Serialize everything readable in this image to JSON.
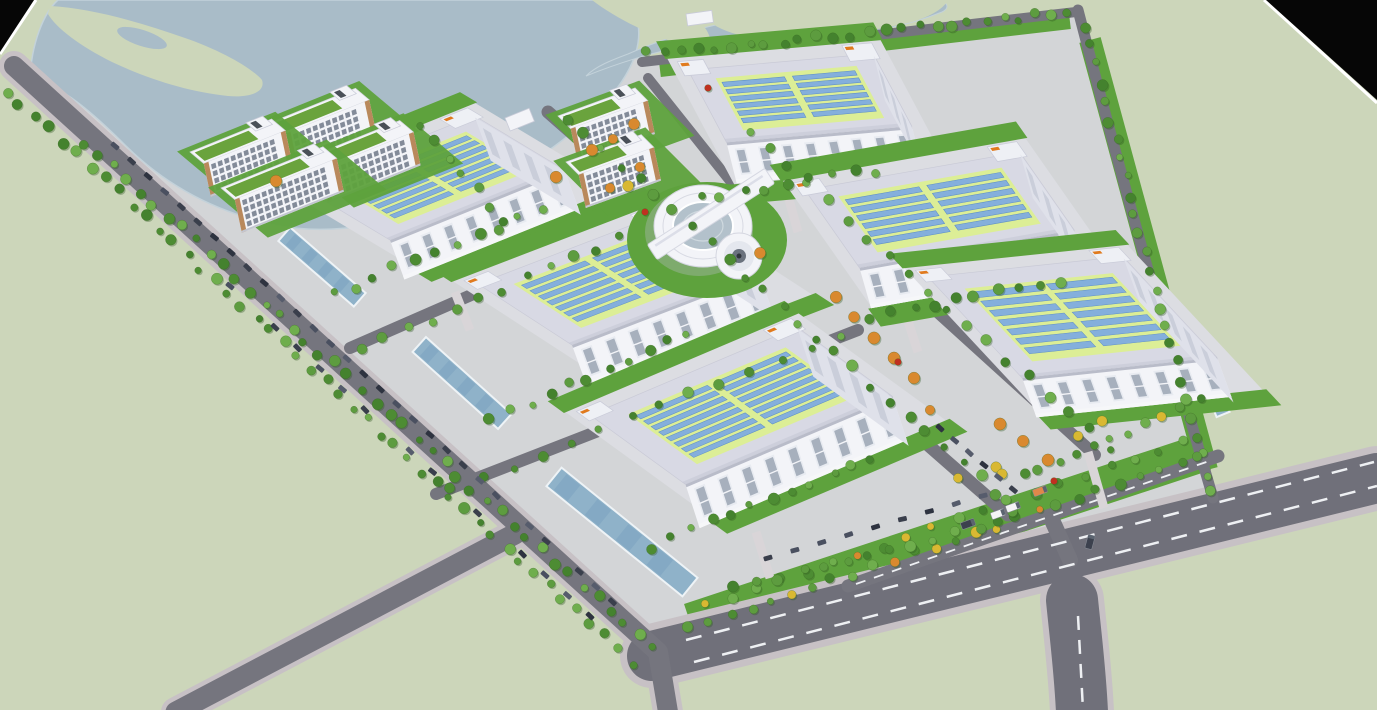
{
  "meta": {
    "description": "Aerial 3D architectural rendering of an industrial campus: six solar-roof warehouses, office slabs, ring-shaped hub building, tree-lined roads, lake at top, black render corners",
    "canvas": {
      "w": 1377,
      "h": 710
    }
  },
  "palette": {
    "land": "#ccd6ba",
    "site": "#d4d5d9",
    "water": "#a9bcc8",
    "waterEdge": "#c3d2da",
    "asphalt": "#75757e",
    "asphaltWide": "#70707a",
    "curb": "#c7c1c5",
    "dash": "#eef0f3",
    "lawn": "#5ea23d",
    "apron": "#dcdde2",
    "roofBorder": "#d8d9e4",
    "roofShadow": "#c6c8d6",
    "roofField": "#dcee96",
    "panel": "#84afdc",
    "panelEdge": "#5d8ec6",
    "white": "#f3f4f8",
    "eave": "#b9bcc9",
    "windowFrame": "#e8ebf1",
    "windowDark": "#a7b0bd",
    "sideWall": "#dfe1ea",
    "penthouse": "#eef0f5",
    "penthouseEdge": "#c9cbd8",
    "orangeMark": "#e07a1e",
    "officeTrim": "#b9895c",
    "officeRoof": "#6aa33d",
    "officeWin": "#6e7888",
    "glass": "#b3c1cb",
    "channel": "#8fb2c9",
    "channelDark": "#7ba3bf",
    "channelEdge": "#eef3f6",
    "walkway": "#d9d5d8",
    "treeGreens": [
      "#4d8c33",
      "#5d9c3f",
      "#6fae4d",
      "#44822e"
    ],
    "treeOrange": "#d9892f",
    "treeYellow": "#d9b832",
    "treeRed": "#c03020",
    "carColors": [
      "#3a3f4c",
      "#2e3340",
      "#4a5060",
      "#565c6c"
    ],
    "black": "#060606",
    "edgeLine": "#ffffff"
  },
  "scene": {
    "site_polygon": "M 30,86 L 640,58 L 1076,12 L 1216,500 L 1066,552 L 658,656 Z",
    "water": {
      "lake": "M 30,80 C 55,82 85,105 125,145 C 165,185 215,212 275,225 C 335,237 395,223 455,200 C 515,177 565,143 605,103 C 630,75 642,48 638,24 C 634,8 618,0 598,0 L 58,0 C 44,12 31,44 30,80 Z",
      "east_arm": "M 586,76 C 660,46 748,30 810,34 C 858,36 902,28 942,12 C 950,8 948,2 938,0 L 900,0 C 858,8 812,14 760,18 C 714,22 664,38 628,54 C 612,60 596,66 586,76 Z",
      "peninsula": "M 50,6 C 90,8 140,22 185,38 C 220,50 252,68 262,80 C 266,92 250,98 228,96 C 190,92 150,80 112,62 C 80,46 56,28 48,14 Z",
      "inlet": {
        "cx": 142,
        "cy": 38,
        "rx": 26,
        "ry": 8,
        "rot": 18
      },
      "tongue": "M 592,0 L 668,0 C 690,10 706,24 710,38 C 702,48 684,46 662,38 C 636,28 610,14 592,0 Z",
      "far_shore": "M 688,0 C 700,18 720,34 756,38 C 812,40 870,32 912,22 C 932,16 944,8 948,0 Z"
    },
    "roads": [
      {
        "name": "south-boulevard-curb",
        "d": "M 652,656 L 1377,478",
        "w": 64,
        "color": "curb"
      },
      {
        "name": "south-branch-curb",
        "d": "M 1072,600 C 1076,640 1080,670 1082,712",
        "w": 64,
        "color": "curb"
      },
      {
        "name": "west-road-curb",
        "d": "M 14,66 L 658,652 L 668,712",
        "w": 30,
        "color": "curb"
      },
      {
        "name": "southwest-access-curb",
        "d": "M 176,712 L 515,534",
        "w": 30,
        "color": "curb"
      },
      {
        "name": "south-boulevard",
        "d": "M 652,656 L 1377,478",
        "w": 50,
        "color": "asphaltWide"
      },
      {
        "name": "south-branch-road",
        "d": "M 1072,600 C 1076,640 1080,670 1082,712",
        "w": 52,
        "color": "asphaltWide"
      },
      {
        "name": "west-perimeter-road",
        "d": "M 14,66 L 658,652 L 668,712",
        "w": 20,
        "color": "asphalt"
      },
      {
        "name": "southwest-access-road",
        "d": "M 176,712 L 515,534",
        "w": 21,
        "color": "asphalt"
      },
      {
        "name": "east-perimeter-road",
        "d": "M 1078,10 Q 1135,230 1213,498",
        "w": 11,
        "color": "asphalt"
      },
      {
        "name": "north-shore-road",
        "d": "M 642,62 L 1076,12",
        "w": 10,
        "color": "asphalt"
      },
      {
        "name": "central-spine-road",
        "d": "M 548,112 L 1008,515",
        "w": 13,
        "color": "asphalt"
      },
      {
        "name": "east-spine-road",
        "d": "M 726,120 L 1095,455",
        "w": 12,
        "color": "asphalt"
      },
      {
        "name": "cross-road-north",
        "d": "M 350,348 L 652,216",
        "w": 12,
        "color": "asphalt"
      },
      {
        "name": "cross-road-south",
        "d": "M 436,494 L 858,330",
        "w": 12,
        "color": "asphalt"
      },
      {
        "name": "office-loop-road",
        "d": "M 648,78 L 742,196",
        "w": 10,
        "color": "asphalt"
      },
      {
        "name": "gate-service-road",
        "d": "M 848,586 L 1218,456",
        "w": 13,
        "color": "asphalt"
      },
      {
        "name": "gate-stub",
        "d": "M 1052,520 L 1070,560",
        "w": 16,
        "color": "asphalt"
      }
    ],
    "lawn_strokes": [
      {
        "d": "M 690,622 L 1205,452",
        "w": 38
      },
      {
        "d": "M 1090,40 Q 1145,240 1207,470",
        "w": 22
      },
      {
        "d": "M 660,70 L 1070,22",
        "w": 14
      }
    ],
    "dashes": [
      {
        "d": "M 694,662 L 1377,486",
        "array": "16 13",
        "w": 2.5
      },
      {
        "d": "M 686,640 L 1374,462",
        "array": "16 13",
        "w": 2.5
      },
      {
        "d": "M 1078,616 L 1083,710",
        "array": "14 10",
        "w": 2.5
      },
      {
        "d": "M 856,584 L 1212,460",
        "array": "10 9",
        "w": 1.8
      }
    ],
    "channels": [
      {
        "cx": 322,
        "cy": 267,
        "len": 100,
        "wid": 18,
        "rot": 41
      },
      {
        "cx": 462,
        "cy": 383,
        "len": 115,
        "wid": 20,
        "rot": 42
      },
      {
        "cx": 622,
        "cy": 532,
        "len": 175,
        "wid": 24,
        "rot": 39
      },
      {
        "cx": 1210,
        "cy": 382,
        "len": 70,
        "wid": 14,
        "rot": 68
      }
    ],
    "warehouses": [
      {
        "o": [
          688,
          70
        ],
        "au": -5,
        "av": 62,
        "w": 186,
        "h": 82,
        "fh": 42,
        "fa": 76,
        "rows": [
          6,
          6
        ]
      },
      {
        "o": [
          805,
          190
        ],
        "au": -10,
        "av": 55,
        "w": 218,
        "h": 95,
        "fh": 42,
        "fa": 74,
        "rows": [
          6,
          6
        ]
      },
      {
        "o": [
          300,
          186
        ],
        "au": -22,
        "av": 31,
        "w": 188,
        "h": 105,
        "fh": 42,
        "fa": 70,
        "rows": [
          7,
          7
        ]
      },
      {
        "o": [
          478,
          284
        ],
        "au": -21,
        "av": 33,
        "w": 200,
        "h": 112,
        "fh": 44,
        "fa": 70,
        "rows": [
          7,
          7
        ]
      },
      {
        "o": [
          928,
          277
        ],
        "au": -6,
        "av": 47,
        "w": 196,
        "h": 138,
        "fh": 42,
        "fa": 70,
        "rows": [
          7,
          7
        ]
      },
      {
        "o": [
          590,
          415
        ],
        "au": -23,
        "av": 36,
        "w": 225,
        "h": 118,
        "fh": 46,
        "fa": 72,
        "rows": [
          8,
          8
        ]
      }
    ],
    "office_style": {
      "roofH": 18,
      "fh": 34,
      "fa": 78,
      "rowCount": 4
    },
    "offices": [
      {
        "o": [
          272,
          122
        ],
        "au": -22,
        "av": 40,
        "w": 90
      },
      {
        "o": [
          190,
          152
        ],
        "au": -22,
        "av": 40,
        "w": 88
      },
      {
        "o": [
          307,
          158
        ],
        "au": -22,
        "av": 40,
        "w": 100
      },
      {
        "o": [
          221,
          188
        ],
        "au": -22,
        "av": 40,
        "w": 110
      },
      {
        "o": [
          558,
          116
        ],
        "au": -20,
        "av": 45,
        "w": 82
      },
      {
        "o": [
          566,
          162
        ],
        "au": -20,
        "av": 45,
        "w": 80
      }
    ],
    "round_building": {
      "cx": 703,
      "cy": 226,
      "barRot": -33,
      "barLen": 140,
      "cylDx": 36,
      "cylDy": 30
    },
    "sheds": [
      {
        "x": 505,
        "y": 118,
        "w": 26,
        "h": 14,
        "rot": -22
      },
      {
        "x": 686,
        "y": 14,
        "w": 26,
        "h": 12,
        "rot": -8
      }
    ],
    "walkways": [
      [
        455,
        292,
        470,
        330
      ],
      [
        756,
        532,
        770,
        578
      ],
      [
        1088,
        452,
        1104,
        508
      ],
      [
        788,
        196,
        798,
        232
      ],
      [
        905,
        312,
        918,
        352
      ]
    ],
    "tree_rows": [
      [
        6,
        90,
        632,
        662,
        46,
        0
      ],
      [
        84,
        142,
        652,
        648,
        42,
        0
      ],
      [
        648,
        54,
        1070,
        13,
        26,
        0
      ],
      [
        1086,
        28,
        1210,
        492,
        26,
        0
      ],
      [
        690,
        628,
        1200,
        458,
        26,
        1
      ],
      [
        706,
        606,
        1185,
        442,
        20,
        1
      ],
      [
        736,
        588,
        1000,
        522,
        13,
        0
      ],
      [
        566,
        118,
        1016,
        510,
        26,
        0
      ],
      [
        748,
        132,
        1108,
        448,
        19,
        0
      ],
      [
        332,
        294,
        540,
        210,
        11,
        0
      ],
      [
        490,
        420,
        688,
        334,
        11,
        0
      ],
      [
        652,
        546,
        872,
        458,
        12,
        0
      ],
      [
        700,
        198,
        876,
        170,
        9,
        0
      ],
      [
        872,
        316,
        1058,
        280,
        10,
        0
      ],
      [
        1022,
        476,
        1200,
        402,
        11,
        1
      ],
      [
        420,
        126,
        506,
        220,
        7,
        0
      ],
      [
        360,
        350,
        622,
        238,
        12,
        0
      ],
      [
        452,
        490,
        840,
        336,
        14,
        0
      ]
    ],
    "accent_trees": {
      "orange": [
        [
          592,
          150
        ],
        [
          613,
          139
        ],
        [
          556,
          177
        ],
        [
          634,
          124
        ],
        [
          836,
          297
        ],
        [
          854,
          317
        ],
        [
          874,
          338
        ],
        [
          894,
          358
        ],
        [
          914,
          378
        ],
        [
          1000,
          424
        ],
        [
          1023,
          441
        ],
        [
          760,
          253
        ],
        [
          640,
          167
        ],
        [
          1048,
          460
        ],
        [
          930,
          410
        ],
        [
          276,
          181
        ],
        [
          610,
          188
        ]
      ],
      "yellow": [
        [
          958,
          478
        ],
        [
          996,
          467
        ],
        [
          1078,
          436
        ],
        [
          1102,
          421
        ],
        [
          1002,
          474
        ],
        [
          628,
          186
        ]
      ],
      "red": [
        [
          645,
          212
        ],
        [
          1054,
          481
        ],
        [
          898,
          362
        ],
        [
          708,
          88
        ]
      ]
    },
    "car_rows": [
      [
        115,
        146,
        629,
        617,
        32
      ],
      [
        230,
        286,
        590,
        616,
        17
      ],
      [
        940,
        428,
        1028,
        502,
        7
      ],
      [
        768,
        558,
        1010,
        488,
        10
      ]
    ],
    "vehicles": [
      {
        "x": 998,
        "y": 514,
        "rot": -20,
        "kind": "white-truck"
      },
      {
        "x": 1013,
        "y": 507,
        "rot": -20,
        "kind": "white-truck"
      },
      {
        "x": 1040,
        "y": 491,
        "rot": -20,
        "kind": "orange-truck"
      },
      {
        "x": 968,
        "y": 524,
        "rot": -20,
        "kind": "dark-car"
      },
      {
        "x": 1090,
        "y": 542,
        "rot": -75,
        "kind": "dark-car"
      }
    ],
    "corners": {
      "top_left": {
        "poly": "0,0 34,0 0,52",
        "edge": "M 36,0 L 0,54"
      },
      "top_right": {
        "poly": "1266,0 1377,0 1377,100",
        "edge": "M 1264,0 L 1377,103"
      }
    }
  }
}
